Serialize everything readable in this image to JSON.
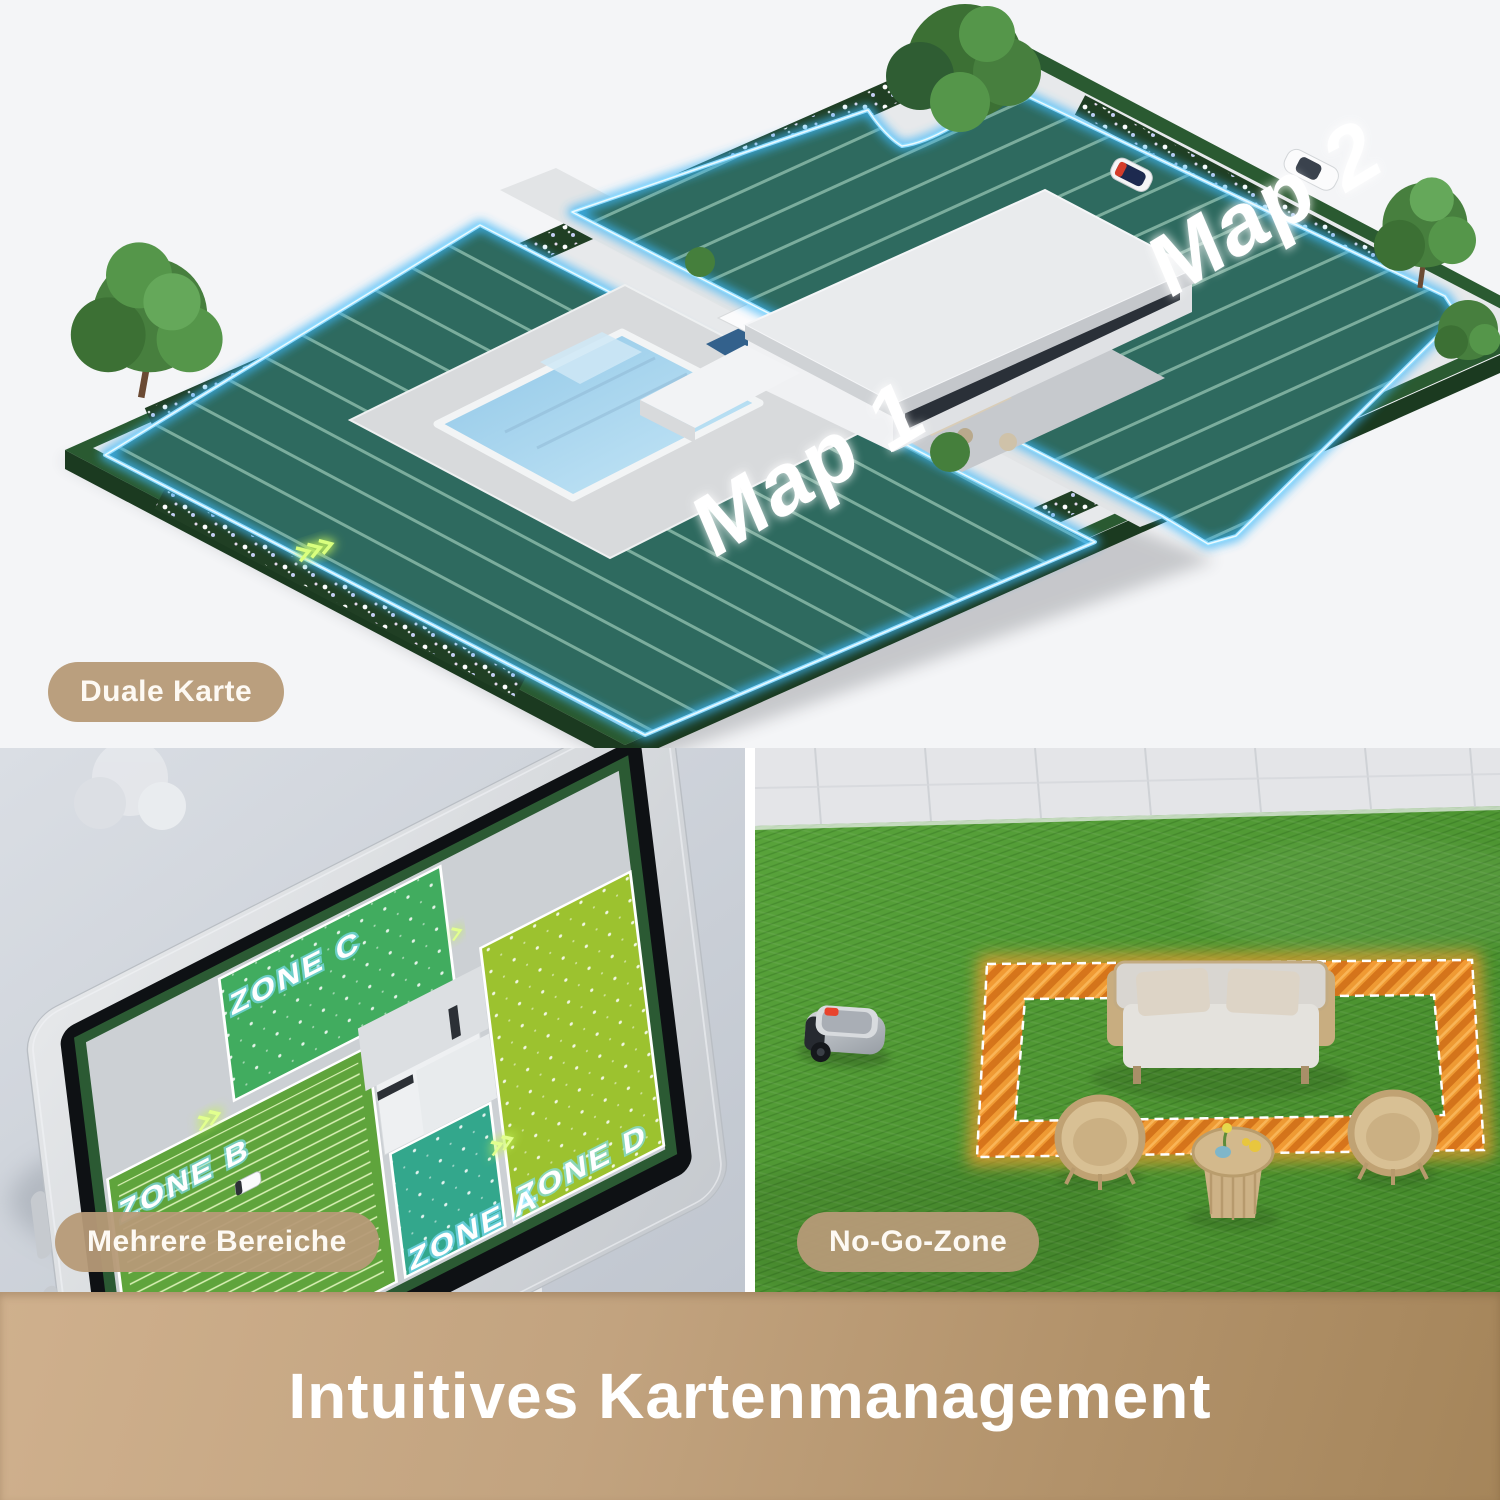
{
  "banner": {
    "title": "Intuitives Kartenmanagement",
    "bg_left": "#cfb08d",
    "bg_right": "#a5855a",
    "text_color": "#ffffff"
  },
  "badges": {
    "dual_map": "Duale Karte",
    "multi_zone": "Mehrere Bereiche",
    "no_go_zone": "No-Go-Zone",
    "bg_color": "#b69a77",
    "text_color": "#fdf9f3"
  },
  "dual_map_panel": {
    "map1_label": "Map 1",
    "map2_label": "Map 2",
    "boundary_color": "#49b8f5",
    "lawn_color": "#2e6a5f",
    "stripe_color": "#b9e3cf",
    "hedge_color": "#2a5a31"
  },
  "zones_panel": {
    "zones": [
      {
        "label": "ZONE C",
        "color": "#41ac5f"
      },
      {
        "label": "ZONE B",
        "color": "#5fa43c"
      },
      {
        "label": "ZONE D",
        "color": "#9cc22f"
      },
      {
        "label": "ZONE A",
        "color": "#33a78c"
      }
    ]
  },
  "no_go_panel": {
    "zone_color": "#f5952f",
    "grass_color": "#4f9a33"
  }
}
